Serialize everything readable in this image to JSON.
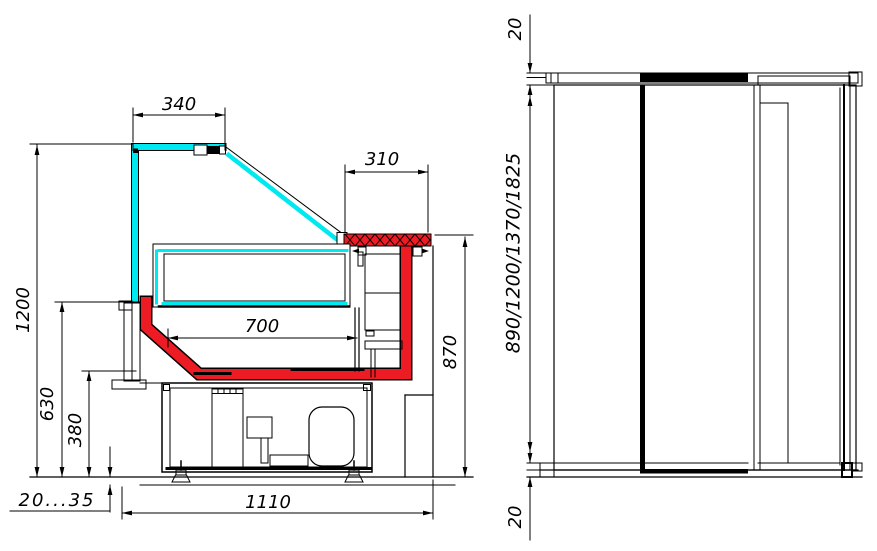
{
  "section_view": {
    "dim_canopy_width": "340",
    "dim_counter_depth": "310",
    "dim_well_width": "700",
    "dim_overall_height": "1200",
    "dim_front_panel_height": "630",
    "dim_well_floor_height": "380",
    "dim_worktop_height": "870",
    "dim_leg_adjust_range": "20...35",
    "dim_overall_depth": "1110"
  },
  "side_view": {
    "dim_top_lid_thickness": "20",
    "dim_length_options": "890/1200/1370/1825",
    "dim_bottom_plinth": "20"
  },
  "colors": {
    "glass_cyan": "#00e9f0",
    "accent_red": "#ed1c24",
    "line": "#000000"
  }
}
